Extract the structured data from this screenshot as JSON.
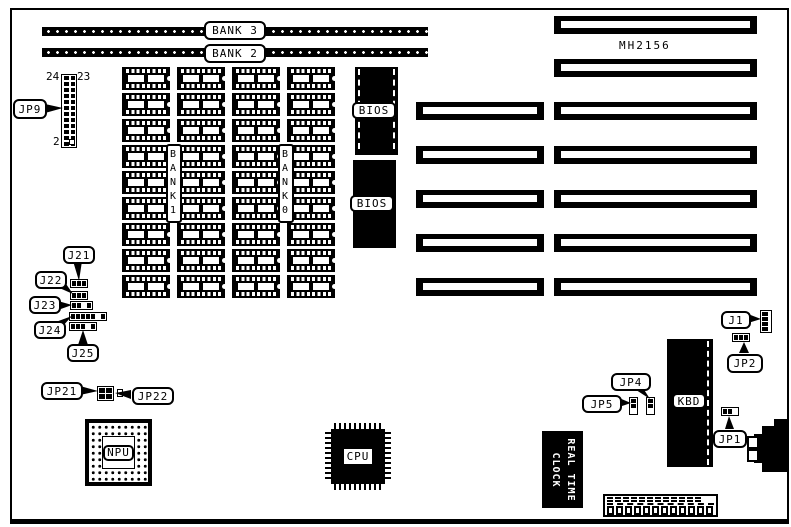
{
  "colors": {
    "ink": "#000000",
    "paper": "#ffffff"
  },
  "board": {
    "model": "MH2156"
  },
  "memory": {
    "bank3": "BANK 3",
    "bank2": "BANK 2",
    "bank1": "BANK1",
    "bank0": "BANK0"
  },
  "rom": {
    "bios_top": "BIOS",
    "bios_bottom": "BIOS"
  },
  "chips": {
    "npu": "NPU",
    "cpu": "CPU",
    "kbd": "KBD",
    "rtc_line1": "REAL TIME",
    "rtc_line2": "CLOCK"
  },
  "connectors": {
    "jp9": "JP9",
    "jp9_pin24": "24",
    "jp9_pin23": "23",
    "jp9_pin2": "2",
    "j21": "J21",
    "j22": "J22",
    "j23": "J23",
    "j24": "J24",
    "j25": "J25",
    "jp21": "JP21",
    "jp22": "JP22",
    "jp4": "JP4",
    "jp5": "JP5",
    "j1": "J1",
    "jp2": "JP2",
    "jp1": "JP1"
  }
}
